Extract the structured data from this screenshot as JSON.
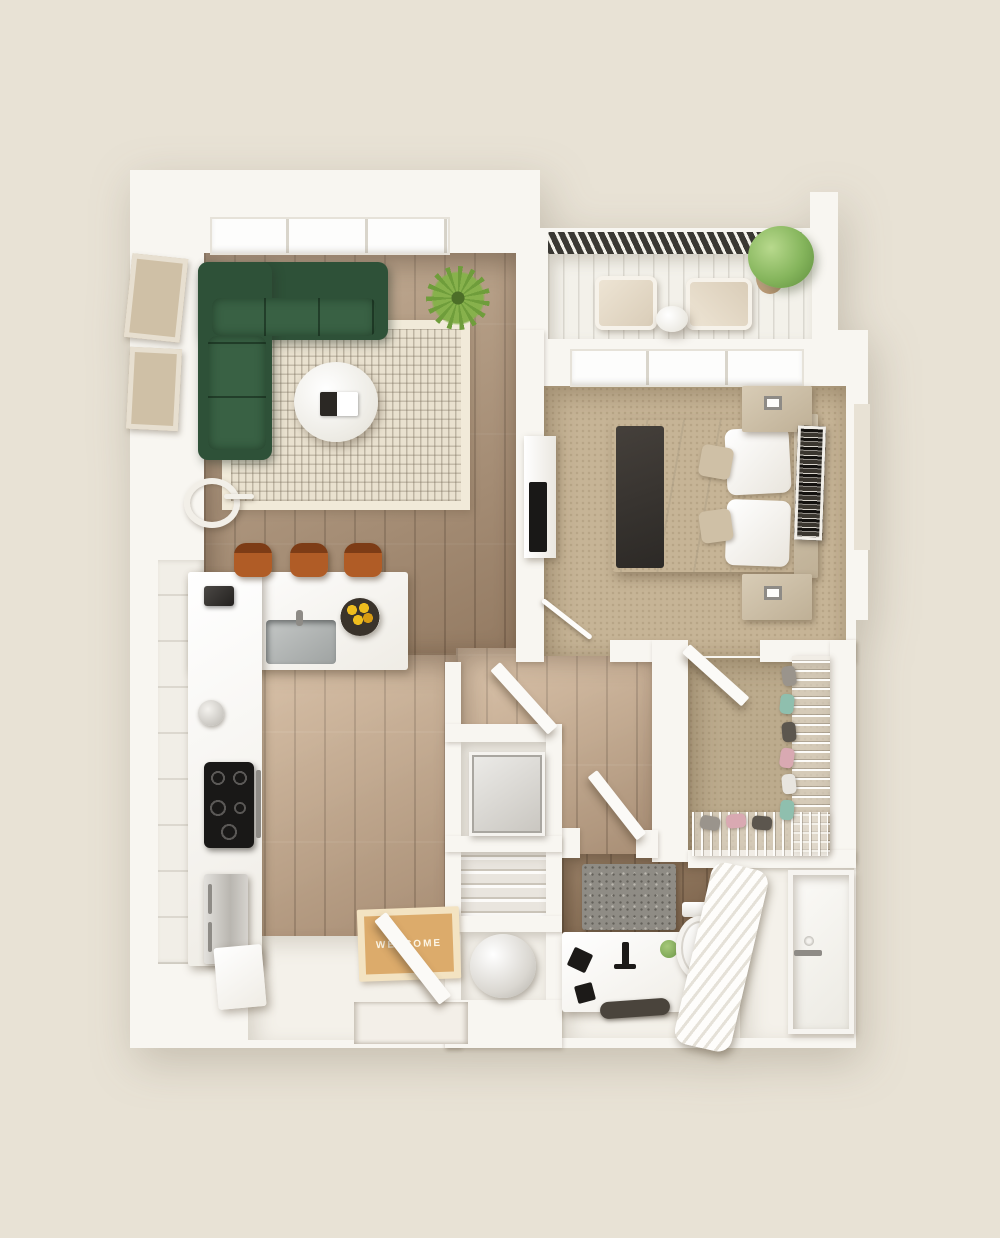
{
  "scene": {
    "description": "3D top-down rendered floor plan of a one-bedroom apartment with balcony",
    "welcome_mat_label": "WELCOME"
  },
  "labels": {
    "welcome_mat": "WELCOME"
  },
  "colors": {
    "bg": "#e8e2d5",
    "wall": "#f8f6f1",
    "wallSoft": "#f1eee7",
    "doorWhite": "#fbfaf7",
    "wood": "#ab9075",
    "carpet": "#c6b496",
    "carpetDark": "#bcab8d",
    "bathTile": "#8d7156",
    "bathFloor": "#f4f1ea",
    "deck": "#f3f1ea",
    "railing": "#3a3833",
    "rug": "#e9e1cf",
    "sofa": "#2e5138",
    "sofaLight": "#396144",
    "stool": "#b05c26",
    "stoolDark": "#7d3c16",
    "plantSpiky": "#6f9d3b",
    "plantLeafy": "#85b55c",
    "pot": "#b08a64",
    "fruit": "#efbd1e",
    "bowlC": "#3a332b",
    "mat": "#dcab6b",
    "matBorder": "#f3e3c2",
    "matText": "#fdf6e6",
    "dark": "#191817",
    "tan": "#cfc0a6",
    "tanDark": "#bfb096",
    "art": "#201e1b",
    "towel": "#4a443c",
    "bathMat": "#8f8c85",
    "curtainShade": "#e5e1d8",
    "shoeTeal": "#8fbfae",
    "shoePink": "#d9a9b2",
    "shoeGray": "#9a948c",
    "shoeWhite": "#e8e5df",
    "shoeDark": "#5c564e"
  }
}
